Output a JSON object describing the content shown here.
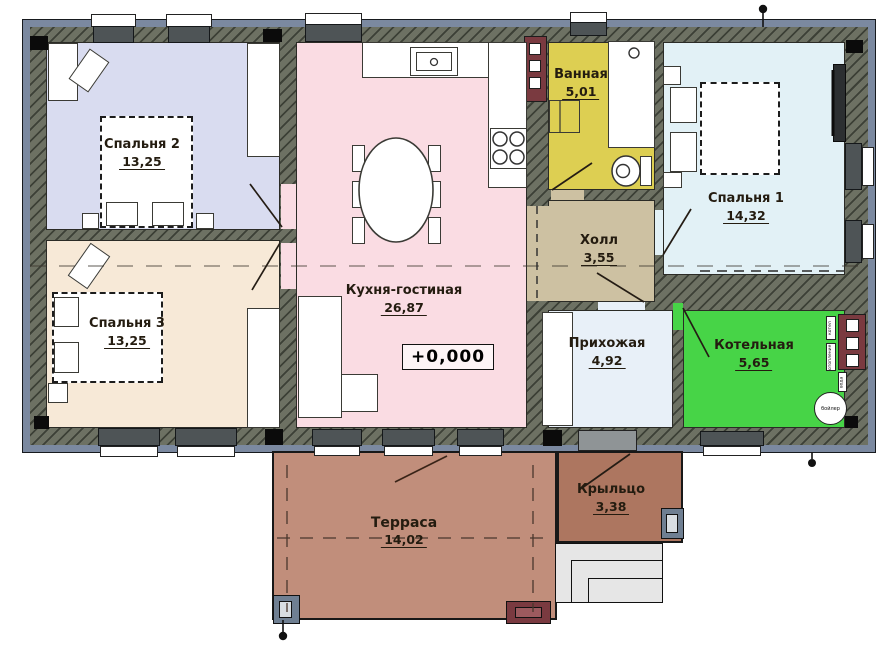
{
  "plan": {
    "title": "Floor plan of single-storey house",
    "elevation": "+0,000",
    "rooms": {
      "bedroom2": {
        "name": "Спальня 2",
        "area": "13,25"
      },
      "bedroom3": {
        "name": "Спальня 3",
        "area": "13,25"
      },
      "kitchen": {
        "name": "Кухня-гостиная",
        "area": "26,87"
      },
      "bathroom": {
        "name": "Ванная",
        "area": "5,01"
      },
      "hall": {
        "name": "Холл",
        "area": "3,55"
      },
      "bedroom1": {
        "name": "Спальня 1",
        "area": "14,32"
      },
      "entry": {
        "name": "Прихожая",
        "area": "4,92"
      },
      "boiler_room": {
        "name": "Котельная",
        "area": "5,65"
      },
      "terrace": {
        "name": "Терраса",
        "area": "14,02"
      },
      "porch": {
        "name": "Крыльцо",
        "area": "3,38"
      }
    },
    "equipment": {
      "boiler_tank": "бойлер",
      "boiler": "котел",
      "heating": "отопление",
      "water": "вода"
    },
    "colors": {
      "wall": "#6d7163",
      "outer_band": "#7b89a0",
      "bedroom2": "#d9dcf0",
      "bedroom3": "#f7e9d7",
      "kitchen": "#fadce3",
      "bathroom": "#ddcf52",
      "hall": "#cdc1a2",
      "bedroom1": "#e2f1f6",
      "entry": "#e8f0f8",
      "boiler_room": "#47d447",
      "terrace": "#c18e7b",
      "porch": "#ad7660",
      "chimney": "#7a3a40"
    }
  }
}
